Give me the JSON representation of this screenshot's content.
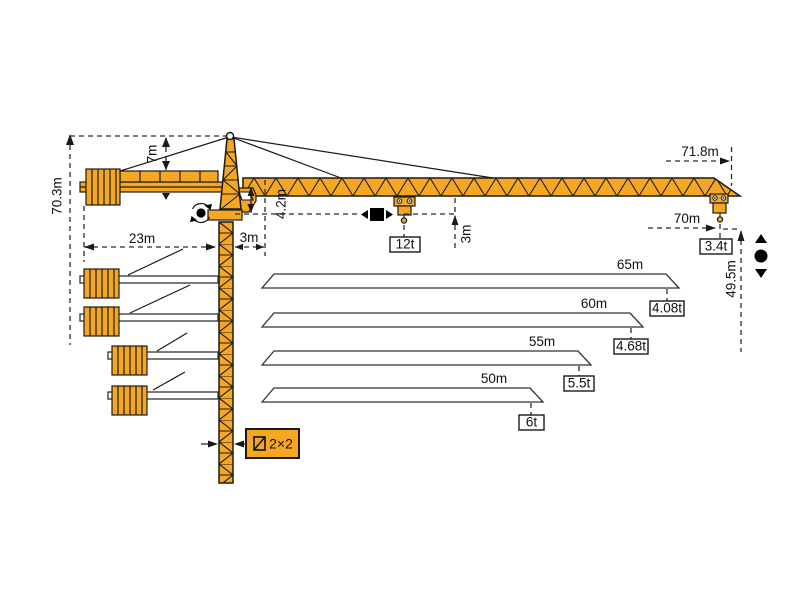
{
  "colors": {
    "crane_yellow": "#F6A722",
    "outline": "#1A1A1A",
    "dimension_line": "#2B2B2B",
    "background": "#FFFFFF"
  },
  "dimensions": {
    "total_height": "70.3m",
    "tower_head_height": "7m",
    "counter_jib_length": "23m",
    "rear_offset": "3m",
    "jib_to_hook_clearance": "4.2m",
    "hook_drop": "3m",
    "max_working_radius": "71.8m",
    "tip_hook_radius": "70m",
    "max_hook_height": "49.5m"
  },
  "loads": {
    "max_capacity": "12t",
    "tip_capacity": "3.4t"
  },
  "mast": {
    "section_size": "2×2"
  },
  "jib_variants": [
    {
      "length": "65m",
      "tip_load": "4.08t"
    },
    {
      "length": "60m",
      "tip_load": "4.68t"
    },
    {
      "length": "55m",
      "tip_load": "5.5t"
    },
    {
      "length": "50m",
      "tip_load": "6t"
    }
  ],
  "icons": {
    "slewing": "dot with rotation arrows",
    "trolley_travel": "square with left-right arrows",
    "hoisting": "dot with up-down arrows",
    "mast_section": "square cross-section glyph"
  }
}
